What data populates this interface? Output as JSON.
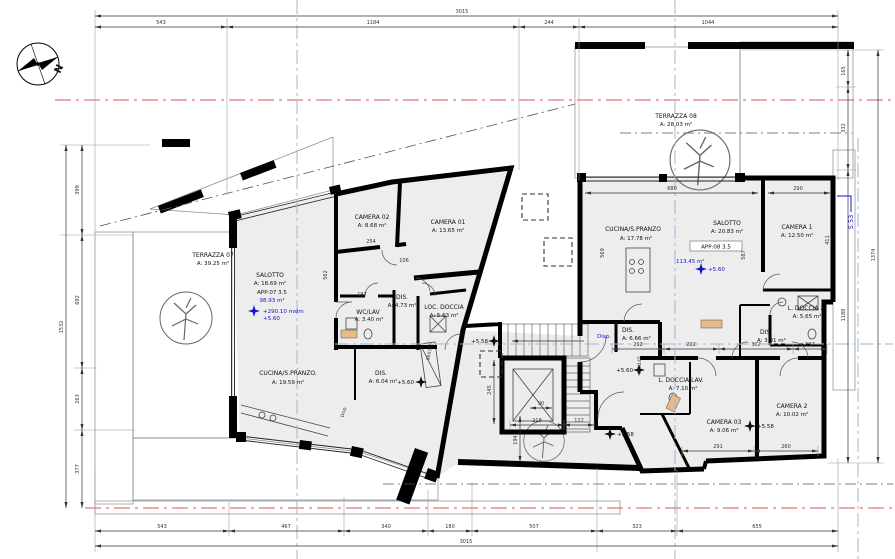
{
  "compass": {
    "n": "N"
  },
  "blue": {
    "s_marker": "S.53",
    "disp": "Disp."
  },
  "levels": {
    "p560": "+5.60",
    "p558": "+5.58"
  },
  "app07": {
    "terrazza_name": "TERRAZZA 07",
    "terrazza_area": "A: 39.25 m²",
    "salotto_name": "SALOTTO",
    "salotto_area": "A: 18.69 m²",
    "unit_id": "APP:07  3.5",
    "unit_area": "98.93 m²",
    "altitude": "+290.10 mslm",
    "camera02_name": "CAMERA 02",
    "camera02_area": "A: 8.68 m²",
    "camera01_name": "CAMERA 01",
    "camera01_area": "A: 13.65 m²",
    "wclav_name": "WC/LAV",
    "wclav_area": "A: 3.40 m²",
    "dis1_name": "DIS.",
    "dis1_area": "A: 4.73 m²",
    "locdoccia_name": "LOC. DOCCIA",
    "locdoccia_area": "A: 5.63 m²",
    "cucina_name": "CUCINA/S.PRANZO.",
    "cucina_area": "A: 19.59 m²",
    "dis2_name": "DIS.",
    "dis2_area": "A: 6.04 m²",
    "closet": "80X175"
  },
  "app08": {
    "terrazza_name": "TERRAZZA 08",
    "terrazza_area": "A: 28.03 m²",
    "cucina_name": "CUCINA/S.PRANZO",
    "cucina_area": "A: 17.78 m²",
    "salotto_name": "SALOTTO",
    "salotto_area": "A: 20.83 m²",
    "unit_id": "APP:08  3.5",
    "unit_area": "113.45 m²",
    "camera1_name": "CAMERA 1",
    "camera1_area": "A: 12.50 m²",
    "ldoccia2_name": "L. DOCCIA 2",
    "ldoccia2_area": "A: 5.65 m²",
    "dis1_name": "DIS.",
    "dis1_area": "A: 6.66 m²",
    "dis2_name": "DIS.",
    "dis2_area": "A: 3.91 m²",
    "ldoccialav_name": "L. DOCCIA/LAV.",
    "ldoccialav_area": "A: 7.10 m²",
    "camera03_name": "CAMERA 03",
    "camera03_area": "A: 9.06 m²",
    "camera2_name": "CAMERA 2",
    "camera2_area": "A: 10.02 m²",
    "closet": "80X145"
  },
  "dims": {
    "top_total": "3015",
    "top": [
      "543",
      "1184",
      "244",
      "1044"
    ],
    "bottom_total": "3015",
    "bottom": [
      "543",
      "467",
      "340",
      "180",
      "507",
      "323",
      "655"
    ],
    "left_total": "1532",
    "left": [
      "399",
      "692",
      "263",
      "377"
    ],
    "right_total": "1374",
    "right": [
      "165",
      "332",
      "1188"
    ],
    "interior": {
      "d680": "680",
      "d290": "290",
      "d569": "569",
      "d587": "587",
      "d411": "411",
      "d562": "562",
      "d254": "254",
      "d106": "106",
      "d197": "197",
      "d212": "212",
      "d222": "222",
      "d302": "302",
      "d137": "137",
      "d291": "291",
      "d260": "260",
      "d218": "218",
      "d122": "122",
      "d90": "90",
      "d245": "245",
      "d194": "194"
    }
  }
}
